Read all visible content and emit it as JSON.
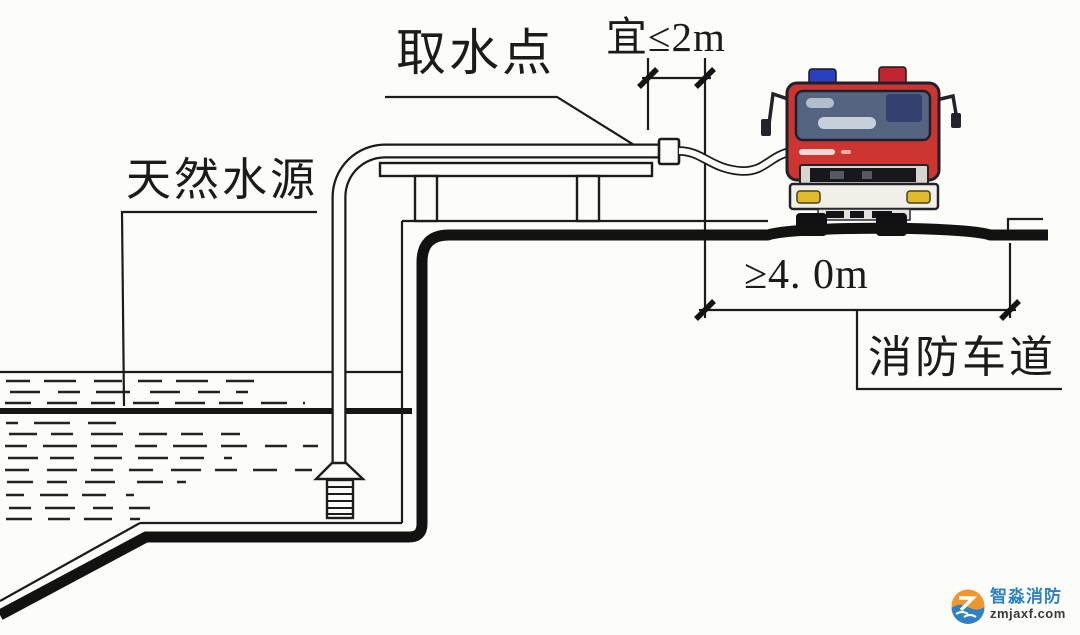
{
  "labels": {
    "intake_point": "取水点",
    "intake_distance": "宜≤2m",
    "natural_water_source": "天然水源",
    "lane_width": "≥4. 0m",
    "fire_lane": "消防车道"
  },
  "watermark": {
    "brand": "智淼消防",
    "site": "zmjaxf.com"
  },
  "colors": {
    "line": "#1c1c1c",
    "truck_red": "#cd3530",
    "windshield": "#556581",
    "beacon_blue": "#2b3fc0",
    "beacon_red": "#c32432",
    "headlight_amber": "#e2bb2d",
    "watermark_blue": "#2e82c4",
    "watermark_orange": "#f0962c"
  }
}
